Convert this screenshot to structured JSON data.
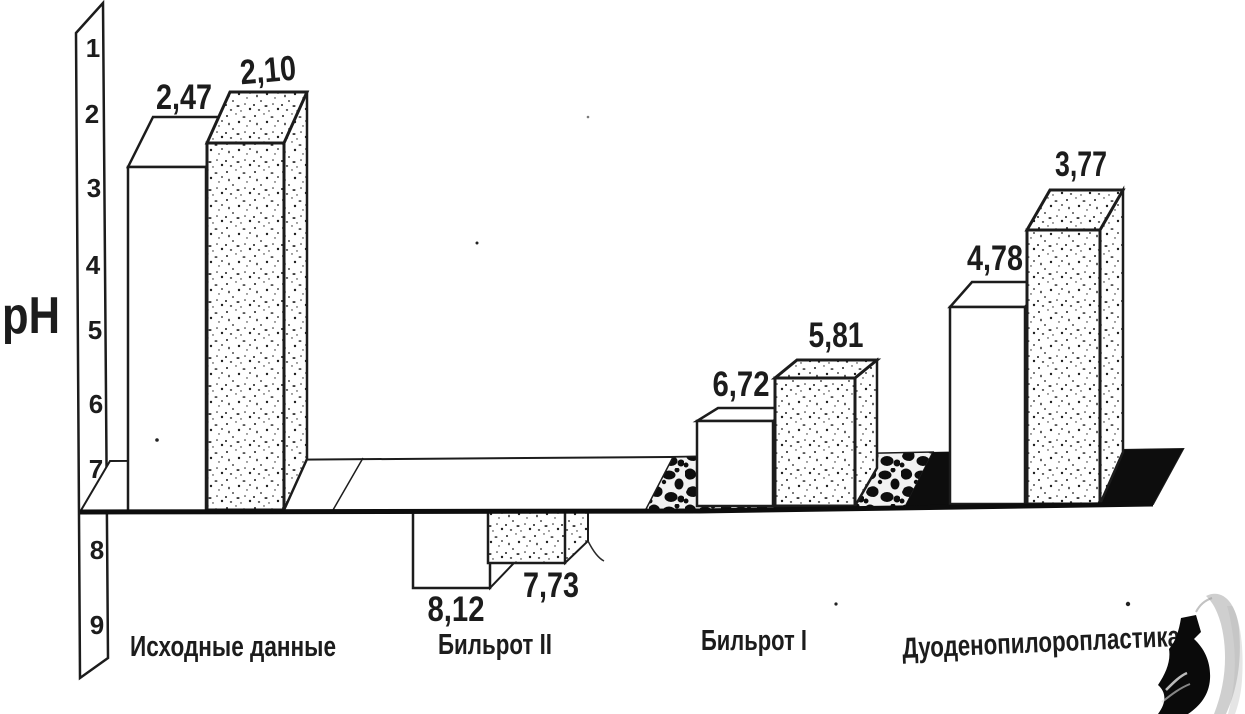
{
  "axis": {
    "label": "pH",
    "ticks": [
      "1",
      "2",
      "3",
      "4",
      "5",
      "6",
      "7",
      "8",
      "9"
    ]
  },
  "groups": [
    {
      "label": "Исходные данные",
      "value_labels": [
        "2,47",
        "2,10"
      ]
    },
    {
      "label": "Бильрот II",
      "value_labels": [
        "8,12",
        "7,73"
      ]
    },
    {
      "label": "Бильрот I",
      "value_labels": [
        "6,72",
        "5,81"
      ]
    },
    {
      "label": "Дуоденопилоропластика",
      "value_labels": [
        "4,78",
        "3,77"
      ]
    }
  ],
  "chart_data": {
    "type": "bar",
    "title": "",
    "ylabel": "pH",
    "xlabel": "",
    "categories": [
      "Исходные данные",
      "Бильрот II",
      "Бильрот I",
      "Дуоденопилоропластика"
    ],
    "series": [
      {
        "name": "white-bars",
        "values": [
          2.47,
          8.12,
          6.72,
          4.78
        ]
      },
      {
        "name": "stippled-bars",
        "values": [
          2.1,
          7.73,
          5.81,
          3.77
        ]
      }
    ],
    "value_label_format": "comma-decimal",
    "y_axis": {
      "ticks": [
        1,
        2,
        3,
        4,
        5,
        6,
        7,
        8,
        9
      ],
      "range": [
        1,
        9
      ],
      "inverted": true,
      "baseline": 7
    },
    "grid": false,
    "legend": false,
    "style": "hand-drawn-3d-scanned-histogram"
  },
  "colors": {
    "ink": "#1c1c1c",
    "paper": "#ffffff",
    "floor_black": "#0d0d0d",
    "smudge_gray": "#b5b5b5"
  }
}
